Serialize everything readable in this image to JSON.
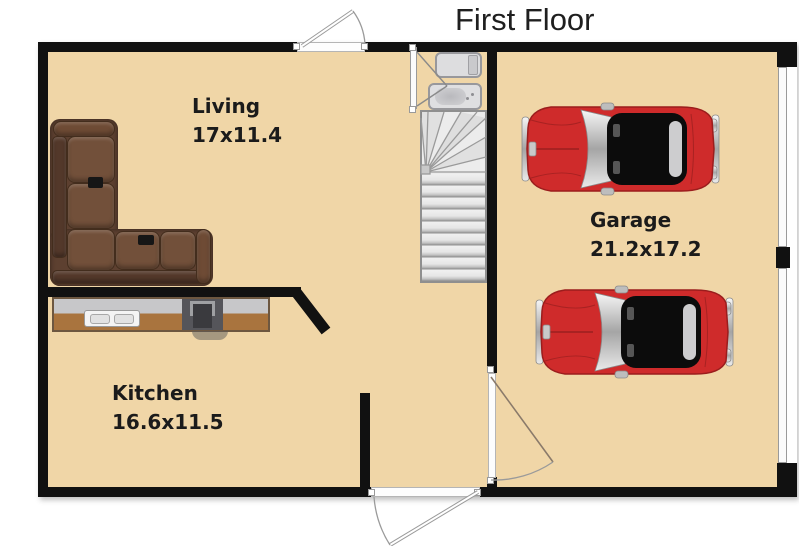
{
  "title": "First Floor",
  "rooms": {
    "living": {
      "label": "Living",
      "dimensions": "17x11.4"
    },
    "kitchen": {
      "label": "Kitchen",
      "dimensions": "16.6x11.5"
    },
    "garage": {
      "label": "Garage",
      "dimensions": "21.2x17.2"
    }
  },
  "colors": {
    "floor": "#F0D6A7",
    "wall": "#111111",
    "title": "#1F1F1F",
    "car_red": "#CF2B2B",
    "sofa_brown": "#72503A",
    "countertop": "#C7C7C9",
    "wood": "#A9743E",
    "stairs": "#ECECEC"
  },
  "icons": {
    "sofa": "l-shaped-sectional-sofa-top-view",
    "car": "red-classic-sports-car-top-view",
    "stairs": "winder-staircase-top-view",
    "toilet": "toilet-top-view",
    "bathtub": "bathtub-top-view",
    "sink": "double-basin-kitchen-sink",
    "stove": "stove-top-view",
    "entry_doors": "hinged-door-with-swing-arc",
    "garage_doors": "garage-door-panel-strips"
  }
}
